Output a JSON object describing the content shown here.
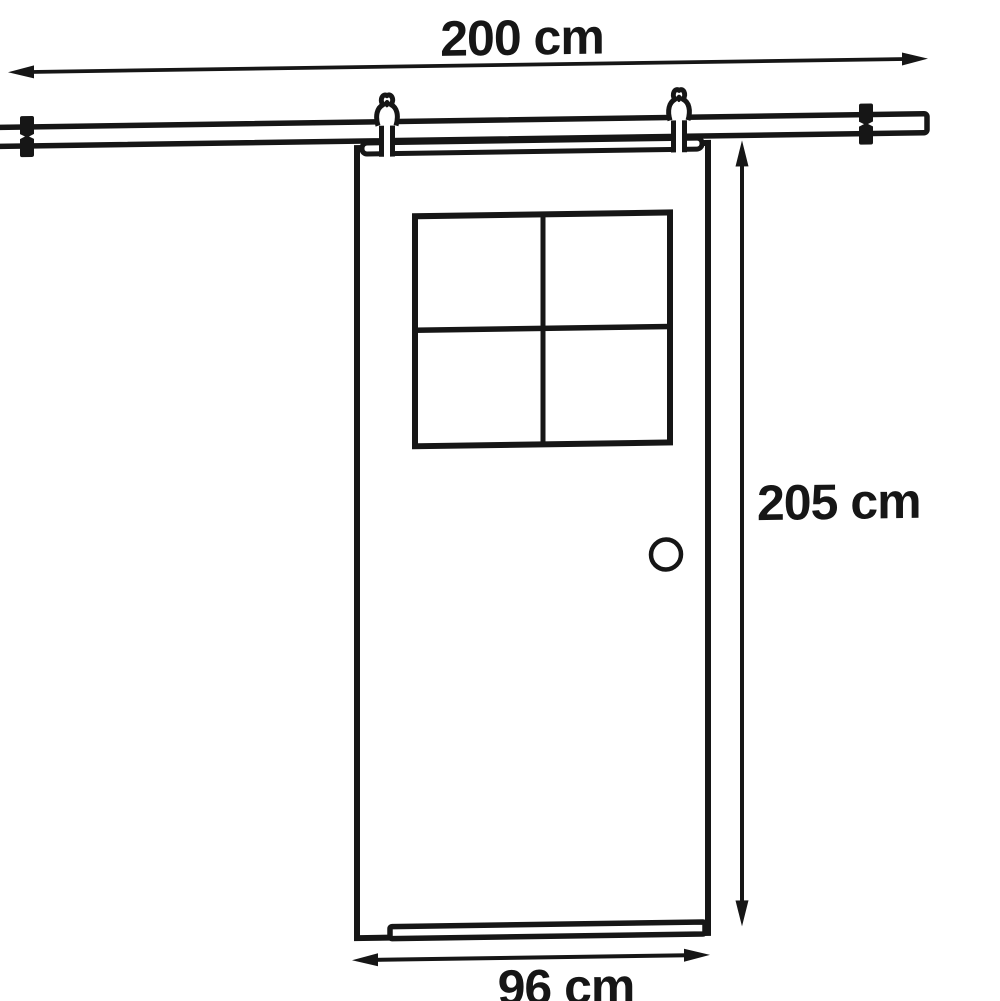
{
  "diagram": {
    "title": "Sliding barn door dimension diagram",
    "dimensions": {
      "track_width": {
        "label": "200 cm",
        "orientation": "horizontal",
        "refers_to": "sliding track rail"
      },
      "door_height": {
        "label": "205 cm",
        "orientation": "vertical",
        "refers_to": "door panel height"
      },
      "door_width": {
        "label": "96 cm",
        "orientation": "horizontal",
        "refers_to": "door panel width"
      }
    },
    "parts": [
      "sliding track rail",
      "wall bracket left",
      "wall bracket right",
      "roller hanger left",
      "roller hanger right",
      "door panel",
      "four-pane window",
      "round door handle"
    ],
    "colors": {
      "line": "#161616",
      "background": "#ffffff"
    }
  }
}
